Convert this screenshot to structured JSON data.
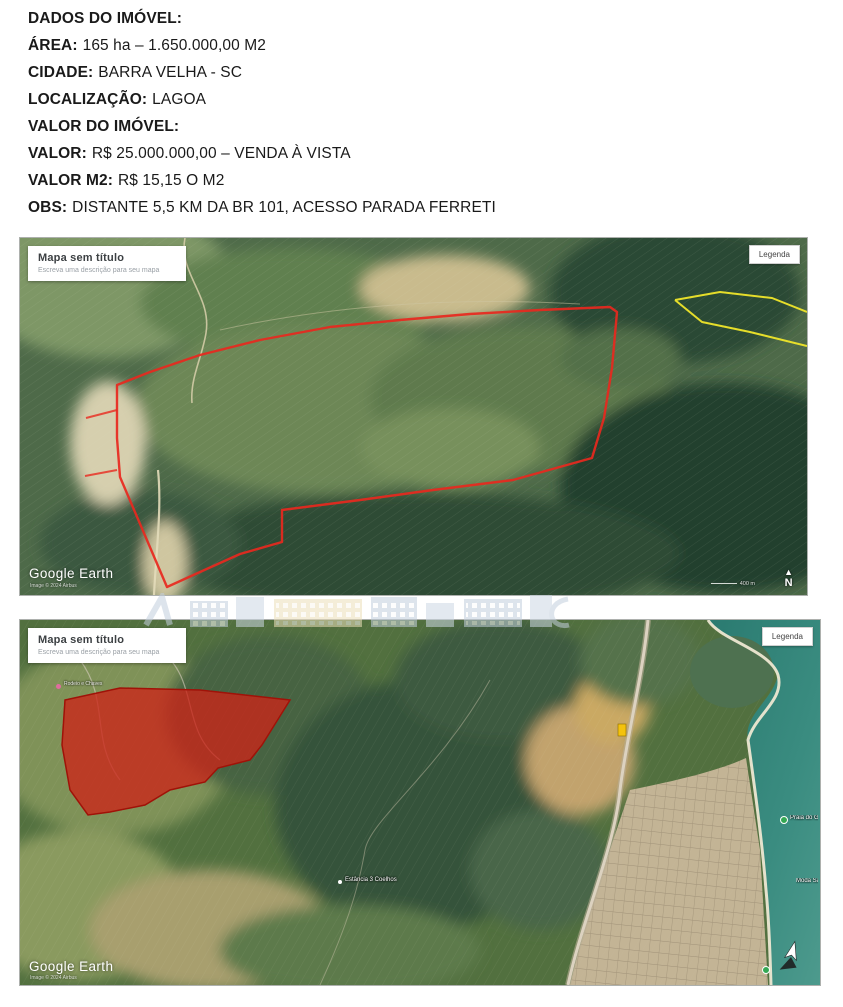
{
  "document": {
    "lines": [
      {
        "label": "DADOS DO IMÓVEL:",
        "value": ""
      },
      {
        "label": "ÁREA:",
        "value": "165 ha – 1.650.000,00 M2"
      },
      {
        "label": "CIDADE:",
        "value": "BARRA VELHA - SC"
      },
      {
        "label": "LOCALIZAÇÃO:",
        "value": "LAGOA"
      },
      {
        "label": "VALOR DO IMÓVEL:",
        "value": ""
      },
      {
        "label": "VALOR:",
        "value": "R$ 25.000.000,00 – VENDA À VISTA"
      },
      {
        "label": "VALOR M2:",
        "value": "R$ 15,15 O M2"
      },
      {
        "label": "OBS:",
        "value": "DISTANTE 5,5 KM DA BR 101, ACESSO PARADA FERRETI"
      }
    ]
  },
  "map_top": {
    "title": "Mapa sem título",
    "subtitle": "Escreva uma descrição para seu mapa",
    "legend_button_label": "Legenda",
    "watermark_text": "Google Earth",
    "attribution_text": "Image © 2024 Airbus",
    "scale_label": "400 m",
    "north_label": "N",
    "property_outline_color": "#e8281e",
    "neighbor_outline_color": "#f0e62a"
  },
  "map_bottom": {
    "title": "Mapa sem título",
    "subtitle": "Escreva uma descrição para seu mapa",
    "legend_button_label": "Legenda",
    "watermark_text": "Google Earth",
    "attribution_text": "Image © 2024 Airbus",
    "north_label": "N",
    "property_fill_color": "#cc2418",
    "place_labels": [
      {
        "text": "Rodeio e Chaves"
      },
      {
        "text": "Estância 3 Coelhos"
      },
      {
        "text": "Praia do Grant"
      },
      {
        "text": "Moda Santa"
      }
    ]
  }
}
